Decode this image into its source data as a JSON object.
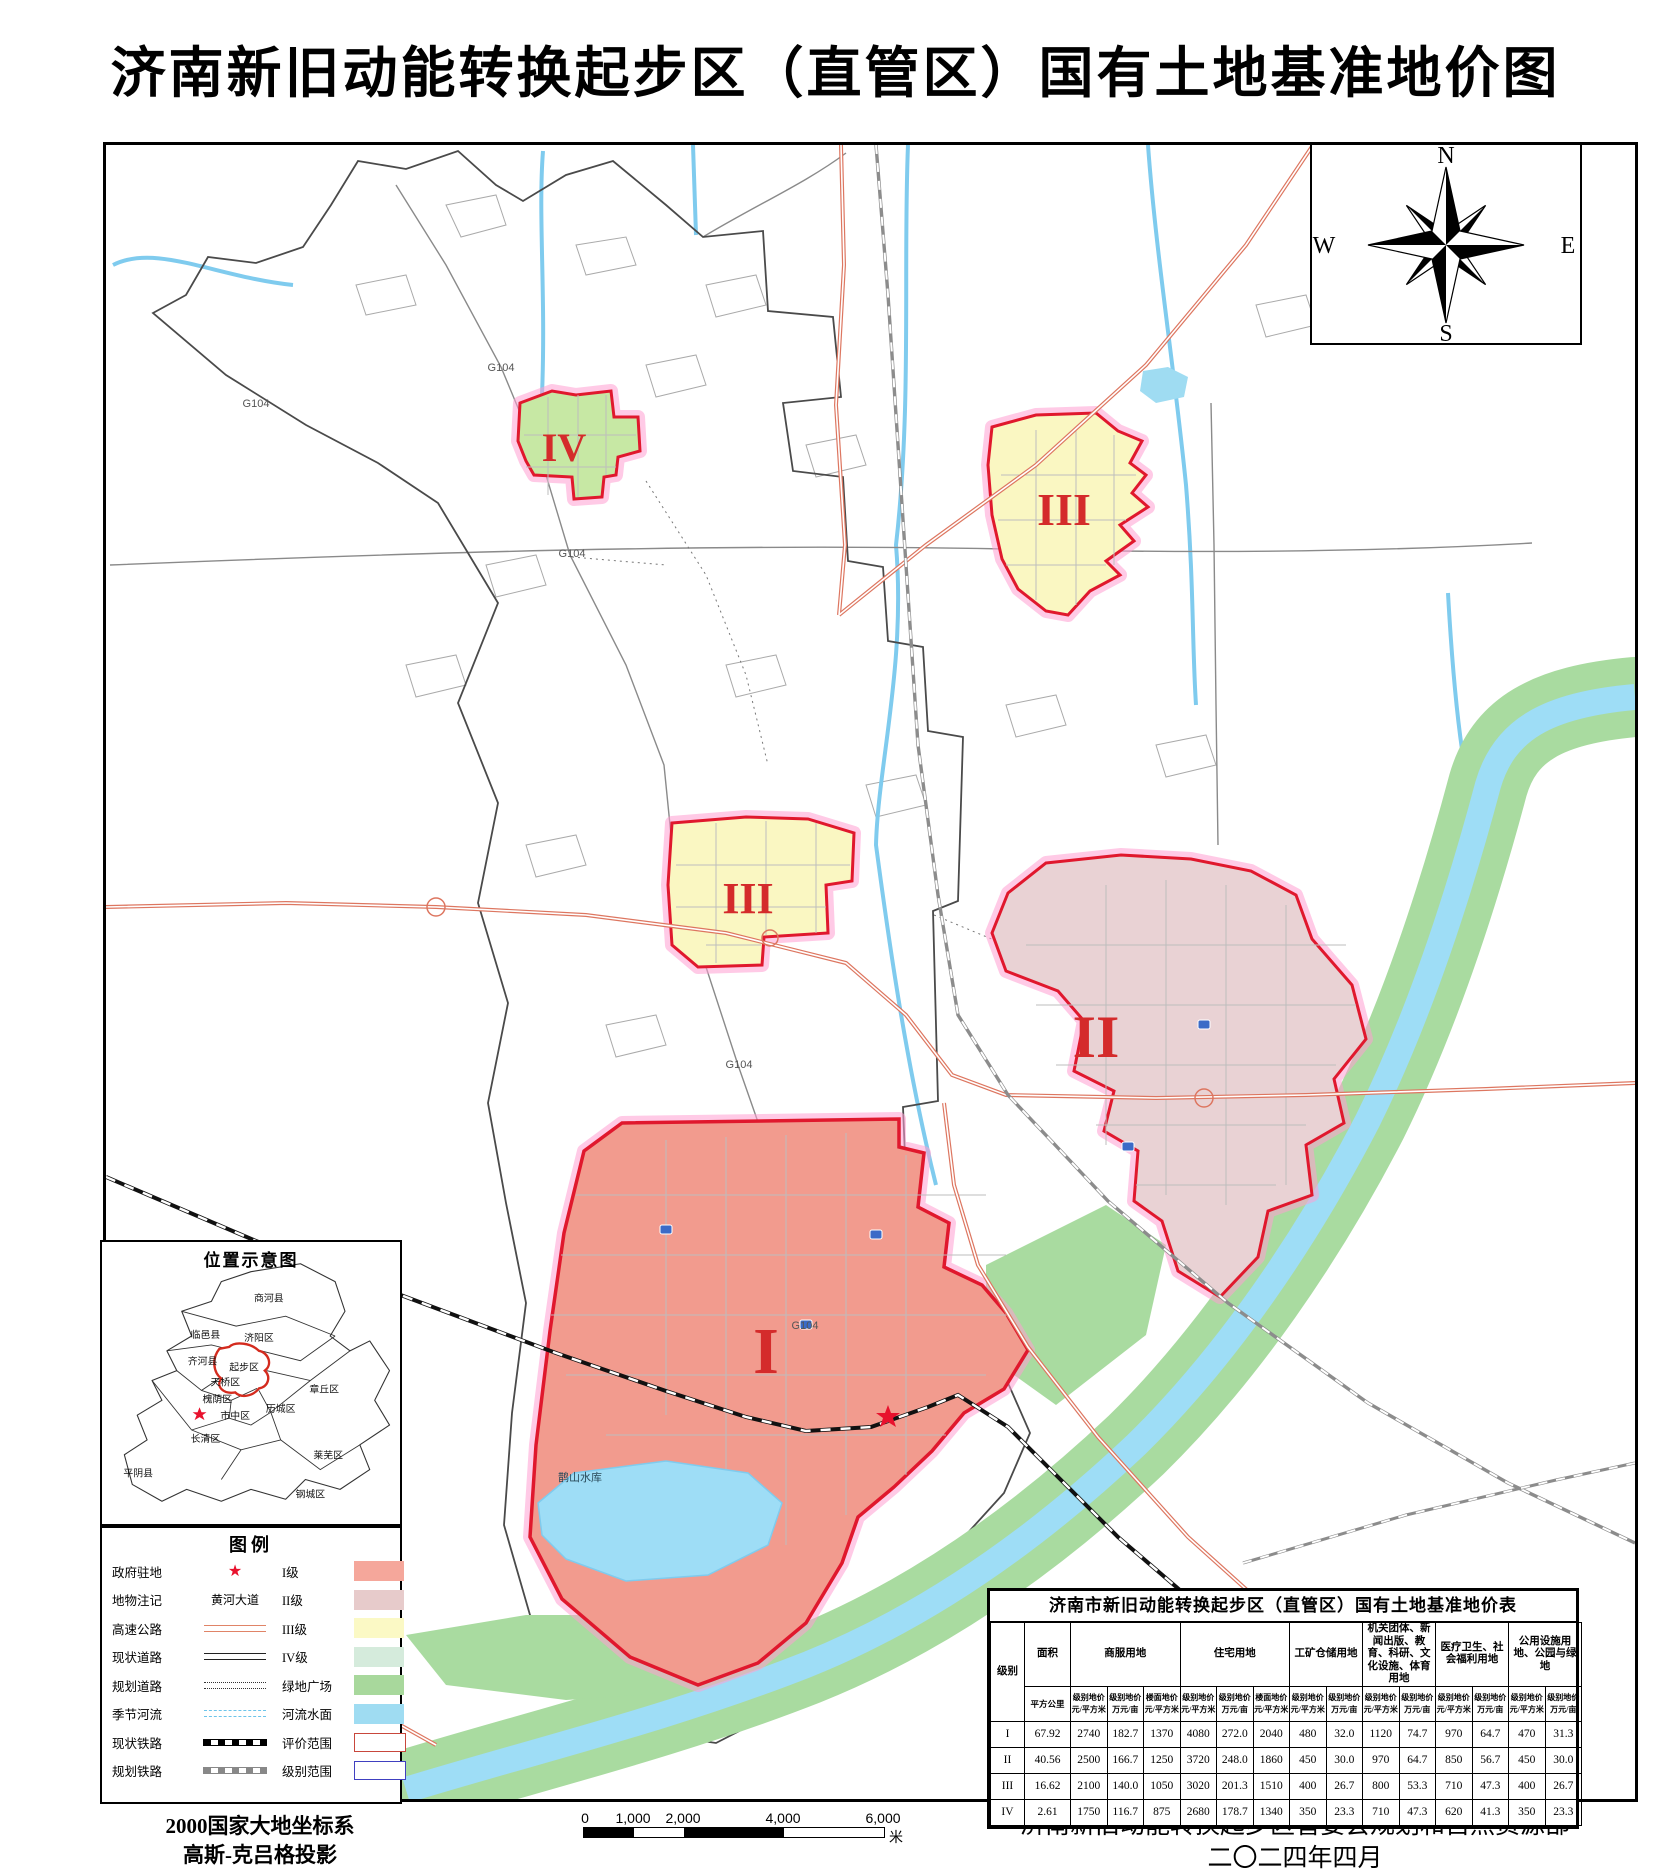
{
  "page": {
    "title": "济南新旧动能转换起步区（直管区）国有土地基准地价图"
  },
  "compass": {
    "n": "N",
    "e": "E",
    "s": "S",
    "w": "W"
  },
  "inset": {
    "title": "位置示意图",
    "districts": [
      {
        "name": "商河县",
        "x": 168,
        "y": 60
      },
      {
        "name": "临邑县",
        "x": 104,
        "y": 97
      },
      {
        "name": "济阳区",
        "x": 158,
        "y": 100
      },
      {
        "name": "齐河县",
        "x": 101,
        "y": 124
      },
      {
        "name": "起步区",
        "x": 143,
        "y": 130
      },
      {
        "name": "天桥区",
        "x": 124,
        "y": 145
      },
      {
        "name": "章丘区",
        "x": 224,
        "y": 152
      },
      {
        "name": "槐荫区",
        "x": 116,
        "y": 162
      },
      {
        "name": "历城区",
        "x": 180,
        "y": 172
      },
      {
        "name": "市中区",
        "x": 134,
        "y": 179
      },
      {
        "name": "长清区",
        "x": 104,
        "y": 202
      },
      {
        "name": "莱芜区",
        "x": 228,
        "y": 219
      },
      {
        "name": "平阴县",
        "x": 36,
        "y": 237
      },
      {
        "name": "钢城区",
        "x": 210,
        "y": 258
      }
    ]
  },
  "legend": {
    "title": "图例",
    "rows": [
      {
        "l": "政府驻地",
        "sym": "star",
        "symText": "",
        "r": "I级",
        "swc": "#F5A79B",
        "swb": ""
      },
      {
        "l": "地物注记",
        "sym": "text",
        "symText": "黄河大道",
        "r": "II级",
        "swc": "#E7CBCB",
        "swb": ""
      },
      {
        "l": "高速公路",
        "sym": "hwy",
        "symText": "",
        "r": "III级",
        "swc": "#FBF9C5",
        "swb": ""
      },
      {
        "l": "现状道路",
        "sym": "road",
        "symText": "",
        "r": "IV级",
        "swc": "#D5EBDC",
        "swb": ""
      },
      {
        "l": "规划道路",
        "sym": "dotted",
        "symText": "",
        "r": "绿地广场",
        "swc": "#A8D89C",
        "swb": ""
      },
      {
        "l": "季节河流",
        "sym": "river",
        "symText": "",
        "r": "河流水面",
        "swc": "#9FDCF2",
        "swb": ""
      },
      {
        "l": "现状铁路",
        "sym": "rail",
        "symText": "",
        "r": "评价范围",
        "swc": "#FFFFFF",
        "swb": "#C8473C"
      },
      {
        "l": "规划铁路",
        "sym": "rail2",
        "symText": "",
        "r": "级别范围",
        "swc": "#FFFFFF",
        "swb": "#4040C0"
      }
    ]
  },
  "map": {
    "zone_labels": [
      {
        "text": "I",
        "x": 660,
        "y": 1228,
        "size": 66
      },
      {
        "text": "II",
        "x": 990,
        "y": 912,
        "size": 60
      },
      {
        "text": "III",
        "x": 958,
        "y": 380,
        "size": 46
      },
      {
        "text": "III",
        "x": 642,
        "y": 768,
        "size": 44
      },
      {
        "text": "IV",
        "x": 458,
        "y": 316,
        "size": 40
      }
    ],
    "road_labels": [
      {
        "text": "G104",
        "x": 395,
        "y": 226
      },
      {
        "text": "G104",
        "x": 466,
        "y": 412
      },
      {
        "text": "G104",
        "x": 633,
        "y": 923
      },
      {
        "text": "G104",
        "x": 699,
        "y": 1184
      },
      {
        "text": "G104",
        "x": 150,
        "y": 262
      }
    ],
    "lake_label": {
      "text": "鹊山水库",
      "x": 452,
      "y": 1336
    },
    "colors": {
      "zone1": "#F29B8E",
      "zone2": "#E9D2D4",
      "zone3": "#FAF7C2",
      "zone4": "#C7E8A4",
      "zone_border": "#E0182D",
      "zone_glow": "#FF9ED2",
      "green": "#A9DBA0",
      "river": "#9EDDF6",
      "stream": "#7FCBEE",
      "highway": "#DD7660"
    }
  },
  "table": {
    "title": "济南市新旧动能转换起步区（直管区）国有土地基准地价表",
    "col1_header": "级别",
    "area_header": "面积",
    "area_unit": "平方公里",
    "groups": [
      {
        "label": "商服用地",
        "cols": [
          [
            "级别地价",
            "元/平方米"
          ],
          [
            "级别地价",
            "万元/亩"
          ],
          [
            "楼面地价",
            "元/平方米"
          ]
        ]
      },
      {
        "label": "住宅用地",
        "cols": [
          [
            "级别地价",
            "元/平方米"
          ],
          [
            "级别地价",
            "万元/亩"
          ],
          [
            "楼面地价",
            "元/平方米"
          ]
        ]
      },
      {
        "label": "工矿仓储用地",
        "cols": [
          [
            "级别地价",
            "元/平方米"
          ],
          [
            "级别地价",
            "万元/亩"
          ]
        ]
      },
      {
        "label": "机关团体、新闻出版、教育、科研、文化设施、体育用地",
        "cols": [
          [
            "级别地价",
            "元/平方米"
          ],
          [
            "级别地价",
            "万元/亩"
          ]
        ]
      },
      {
        "label": "医疗卫生、社会福利用地",
        "cols": [
          [
            "级别地价",
            "元/平方米"
          ],
          [
            "级别地价",
            "万元/亩"
          ]
        ]
      },
      {
        "label": "公用设施用地、公园与绿地",
        "cols": [
          [
            "级别地价",
            "元/平方米"
          ],
          [
            "级别地价",
            "万元/亩"
          ]
        ]
      }
    ],
    "rows": [
      {
        "grade": "I",
        "values": [
          "67.92",
          "2740",
          "182.7",
          "1370",
          "4080",
          "272.0",
          "2040",
          "480",
          "32.0",
          "1120",
          "74.7",
          "970",
          "64.7",
          "470",
          "31.3"
        ]
      },
      {
        "grade": "II",
        "values": [
          "40.56",
          "2500",
          "166.7",
          "1250",
          "3720",
          "248.0",
          "1860",
          "450",
          "30.0",
          "970",
          "64.7",
          "850",
          "56.7",
          "450",
          "30.0"
        ]
      },
      {
        "grade": "III",
        "values": [
          "16.62",
          "2100",
          "140.0",
          "1050",
          "3020",
          "201.3",
          "1510",
          "400",
          "26.7",
          "800",
          "53.3",
          "710",
          "47.3",
          "400",
          "26.7"
        ]
      },
      {
        "grade": "IV",
        "values": [
          "2.61",
          "1750",
          "116.7",
          "875",
          "2680",
          "178.7",
          "1340",
          "350",
          "23.3",
          "710",
          "47.3",
          "620",
          "41.3",
          "350",
          "23.3"
        ]
      }
    ]
  },
  "scalebar": {
    "labels": [
      "0",
      "1,000",
      "2,000",
      "4,000",
      "6,000"
    ],
    "unit": "米"
  },
  "footer": {
    "left_line1": "2000国家大地坐标系",
    "left_line2": "高斯-克吕格投影",
    "right_line1": "济南新旧动能转换起步区管委会规划和自然资源部",
    "right_line2": "二〇二四年四月"
  }
}
